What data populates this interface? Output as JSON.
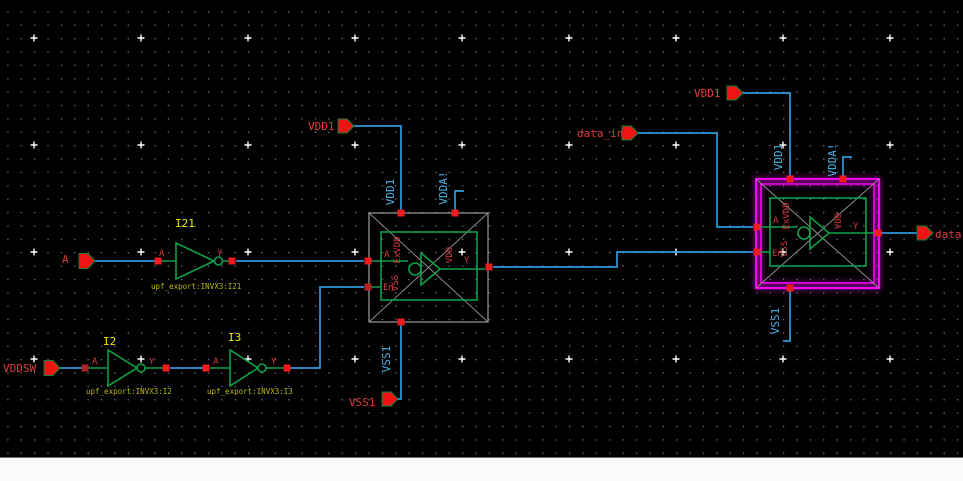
{
  "colors": {
    "background": "#000000",
    "wire": "#2e9ada",
    "symbol_green": "#0da04a",
    "pin_red": "#ee1c1c",
    "port_text_red": "#e03c3c",
    "instance_name_yellow": "#e9e900",
    "instance_label_olive": "#b9ba12",
    "net_label_cyan": "#4fb0e4",
    "selection_magenta": "#ff00ff",
    "symbol_box_gray": "#9b9b9b"
  },
  "ports": {
    "a": "A",
    "vddsw": "VDDSW",
    "vdd1_mid": "VDD1",
    "vss1_mid": "VSS1",
    "data_in": "data_in",
    "vdd1_right": "VDD1",
    "data_out": "data"
  },
  "nets": {
    "vdd1_mid": "VDD1",
    "vdda_mid": "VDDA!",
    "vss1_mid": "VSS1",
    "vdd1_right": "VDD1",
    "vdda_right": "VDDA!",
    "vss1_right": "VSS1"
  },
  "inverters": {
    "i21": {
      "name": "I21",
      "cell_label": "upf_export:INVX3:I21",
      "a": "A",
      "y": "Y"
    },
    "i2": {
      "name": "I2",
      "cell_label": "upf_export:INVX3:I2",
      "a": "A",
      "y": "Y"
    },
    "i3": {
      "name": "I3",
      "cell_label": "upf_export:INVX3:I3",
      "a": "A",
      "y": "Y"
    }
  },
  "cells": {
    "mid": {
      "a": "A",
      "en": "En",
      "y": "Y",
      "vdd": "VDD",
      "exvdd": "ExVDD",
      "vss": "VSS"
    },
    "right": {
      "a": "A",
      "en": "En",
      "y": "Y",
      "vdd": "VDD",
      "exvdd": "ExVDD",
      "vss": "VSS"
    }
  }
}
